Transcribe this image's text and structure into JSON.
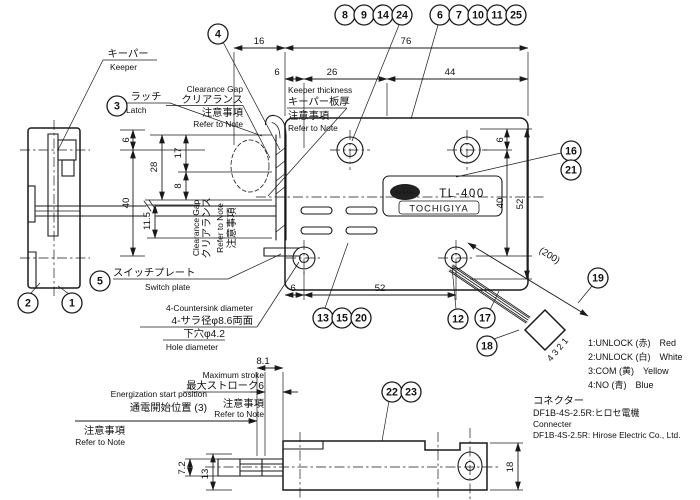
{
  "drawing": {
    "nameplate": {
      "model": "TL-400",
      "brand": "TOCHIGIYA",
      "logo": "TOCHIGIYA"
    },
    "balloons": {
      "b1": "1",
      "b2": "2",
      "b3": "3",
      "b4": "4",
      "b5": "5",
      "b6": "6",
      "b7": "7",
      "b8": "8",
      "b9": "9",
      "b10": "10",
      "b11": "11",
      "b12": "12",
      "b13": "13",
      "b14": "14",
      "b15": "15",
      "b16": "16",
      "b17": "17",
      "b18": "18",
      "b19": "19",
      "b20": "20",
      "b21": "21",
      "b22": "22",
      "b23": "23",
      "b24": "24",
      "b25": "25"
    },
    "dims": {
      "n6": "6",
      "n8": "8",
      "n13": "13",
      "n16": "16",
      "n17": "17",
      "n18": "18",
      "n26": "26",
      "n28": "28",
      "n40": "40",
      "n44": "44",
      "n52": "52",
      "n76": "76",
      "n81": "8.1",
      "n72": "7.2",
      "n115": "11.5",
      "n200": "(200)"
    },
    "labels": {
      "keeper_jp": "キーパー",
      "keeper_en": "Keeper",
      "latch_jp": "ラッチ",
      "latch_en": "Latch",
      "clearance_en": "Clearance Gap",
      "clearance_jp": "クリアランス",
      "note_jp": "注意事項",
      "note_en": "Refer to Note",
      "keeper_thickness_en": "Keeper thickness",
      "keeper_thickness_jp": "キーパー板厚",
      "switch_plate_jp": "スイッチプレート",
      "switch_plate_en": "Switch plate",
      "countersink_en": "4-Countersink diameter",
      "countersink_jp": "4-サラ径φ8.6両面",
      "pilot_hole_jp": "下穴φ4.2",
      "hole_diameter_en": "Hole diameter",
      "energization_en": "Energization start position",
      "energization_jp": "通電開始位置 (3)",
      "max_stroke_en": "Maximum stroke",
      "max_stroke_jp": "最大ストローク6",
      "connector_jp": "コネクター",
      "connector_model_jp": "DF1B-4S-2.5R:ヒロセ電機",
      "connector_en": "Connecter",
      "connector_model_en": "DF1B-4S-2.5R: Hirose Electric Co., Ltd.",
      "pins": "4 3 2 1"
    },
    "wires": [
      "1:UNLOCK (赤)　Red",
      "2:UNLOCK (白)　White",
      "3:COM (黄)　Yellow",
      "4:NO (青)　Blue"
    ]
  }
}
